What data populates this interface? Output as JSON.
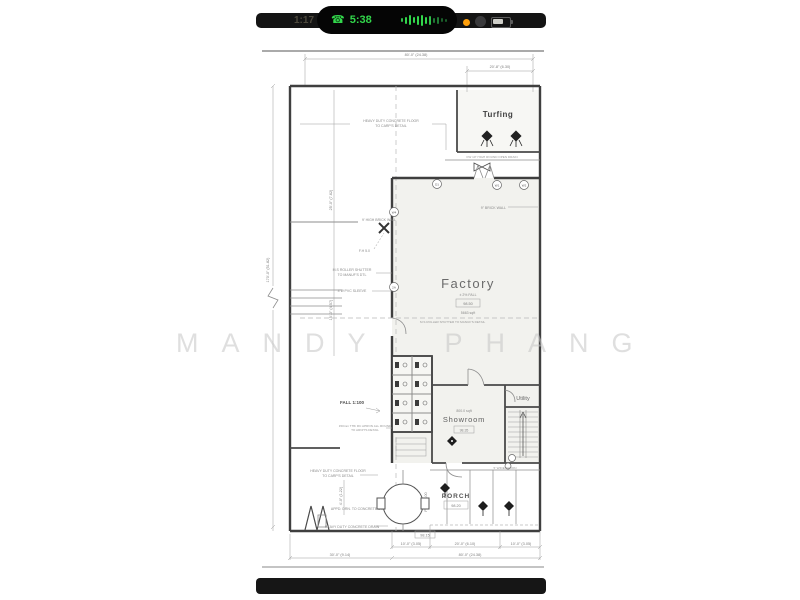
{
  "watermark": "MANDY PHANG",
  "status_bar": {
    "time": "1:17",
    "call_duration": "5:38"
  },
  "colors": {
    "call_green": "#32d74b",
    "mic_orange": "#ff9f0a",
    "wall_gray": "#3f3f3f",
    "note_gray": "#8a8a8a",
    "watermark_gray": "#c6c6c6"
  },
  "plan": {
    "rooms": {
      "turfing": "Turfing",
      "factory": {
        "label": "Factory",
        "note": "± 2% FALL",
        "ffl": "98.50",
        "area": "5663 sqft"
      },
      "showroom": {
        "area": "800.0 sqft",
        "label": "Showroom",
        "ffl": "98.35"
      },
      "utility": "Utility",
      "porch": {
        "label": "PORCH",
        "ffl": "98.20"
      }
    },
    "dims": {
      "top_overall": "80'-0\" (24.38)",
      "top_right": "20'-8\" (6.30)",
      "left_overall": "170'-0\" (51.82)",
      "left_upper": "25'-0\" (7.62)",
      "left_lower": "15'-0\" (4.57)",
      "apron": "4'-0\" (1.22)",
      "bottom_seg1": "30'-0\" (9.14)",
      "bottom_seg2": "10'-0\" (3.05)",
      "bottom_seg3": "20'-0\" (6.10)",
      "bottom_seg4": "10'-0\" (3.05)",
      "bottom_overall": "80'-0\" (24.38)",
      "ffl_box": "98.15"
    },
    "notes": {
      "fall_main": "FALL 1:100",
      "fall_porch": "FALL 1:100",
      "heavy1a": "HEAVY DUTY CONCRETE FLOOR",
      "heavy1b": "TO CARP'S DETAIL",
      "brick_left": "9' HIGH BRICK WALL",
      "fh": "F.H 5.0",
      "shutter_a": "M.S ROLLER SHUTTER",
      "shutter_b": "TO MANUF'S DTL",
      "pvc": "4\"Ø PVC SLEEVE",
      "brick_right": "9\" BRICK WALL",
      "shutter_factory": "M.S ROLLER SHUTTER TO MANUF'S DETAIL",
      "turf_drain": "FW 10\" HIGH ROUND OPEN DRAIN",
      "apron_a": "150mm THK RC APRON ALL ROUND",
      "apron_b": "TO ARCH'S DETAIL",
      "heavy2a": "HEAVY DUTY CONCRETE FLOOR",
      "heavy2b": "TO CARP'S DETAIL",
      "appd": "APPD. DRN. TO CONCRETE DRAIN",
      "heavy_drain": "HEAVY DUTY CONCRETE DRAIN",
      "stair_apron": "5' WIDE APRON"
    },
    "markers": {
      "m1": "D1",
      "m2": "W1",
      "m3": "W2",
      "m4": "W4",
      "m5": "2A"
    }
  }
}
